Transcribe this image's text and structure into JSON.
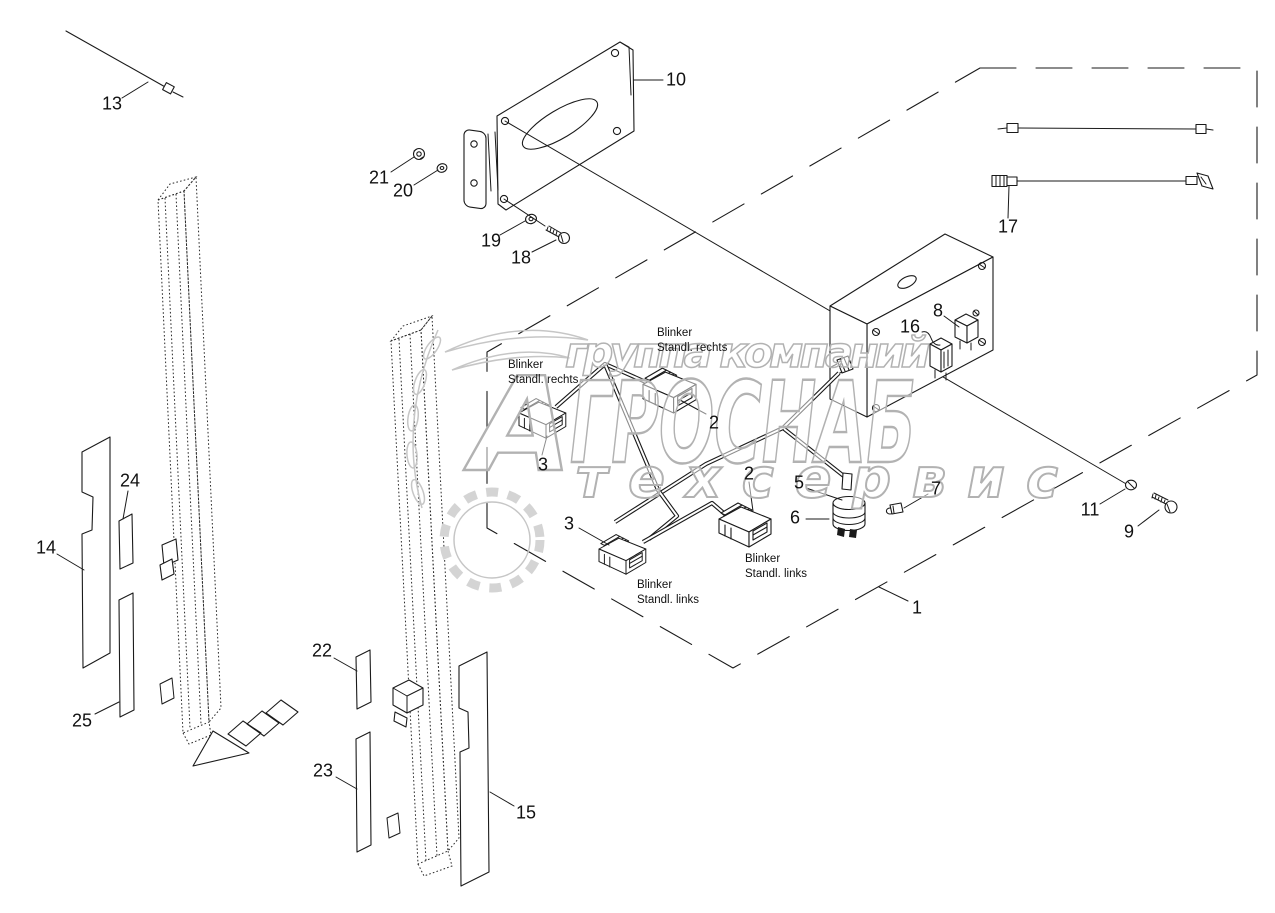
{
  "watermark": {
    "row1": "группа компаний",
    "row2_initial": "А",
    "row2_rest": "ГРОСНАБ",
    "row3": "техсервис"
  },
  "callouts": [
    {
      "label": "1",
      "x": 917,
      "y": 608
    },
    {
      "label": "2",
      "x": 714,
      "y": 423
    },
    {
      "label": "2",
      "x": 749,
      "y": 474
    },
    {
      "label": "3",
      "x": 543,
      "y": 465
    },
    {
      "label": "3",
      "x": 569,
      "y": 524
    },
    {
      "label": "5",
      "x": 799,
      "y": 483
    },
    {
      "label": "6",
      "x": 795,
      "y": 518
    },
    {
      "label": "7",
      "x": 936,
      "y": 489
    },
    {
      "label": "8",
      "x": 938,
      "y": 311
    },
    {
      "label": "9",
      "x": 1129,
      "y": 532
    },
    {
      "label": "10",
      "x": 676,
      "y": 80
    },
    {
      "label": "11",
      "x": 1090,
      "y": 510
    },
    {
      "label": "13",
      "x": 112,
      "y": 104
    },
    {
      "label": "14",
      "x": 46,
      "y": 548
    },
    {
      "label": "15",
      "x": 526,
      "y": 813
    },
    {
      "label": "16",
      "x": 910,
      "y": 327
    },
    {
      "label": "17",
      "x": 1008,
      "y": 227
    },
    {
      "label": "18",
      "x": 521,
      "y": 258
    },
    {
      "label": "19",
      "x": 491,
      "y": 241
    },
    {
      "label": "20",
      "x": 403,
      "y": 191
    },
    {
      "label": "21",
      "x": 379,
      "y": 178
    },
    {
      "label": "22",
      "x": 322,
      "y": 651
    },
    {
      "label": "23",
      "x": 323,
      "y": 771
    },
    {
      "label": "24",
      "x": 130,
      "y": 481
    },
    {
      "label": "25",
      "x": 82,
      "y": 721
    }
  ],
  "captions": [
    {
      "line1": "Blinker",
      "line2": "Standl. rechts",
      "x": 508,
      "y": 358
    },
    {
      "line1": "Blinker",
      "line2": "Standl. rechts",
      "x": 657,
      "y": 326
    },
    {
      "line1": "Blinker",
      "line2": "Standl. links",
      "x": 637,
      "y": 578
    },
    {
      "line1": "Blinker",
      "line2": "Standl. links",
      "x": 745,
      "y": 552
    }
  ]
}
